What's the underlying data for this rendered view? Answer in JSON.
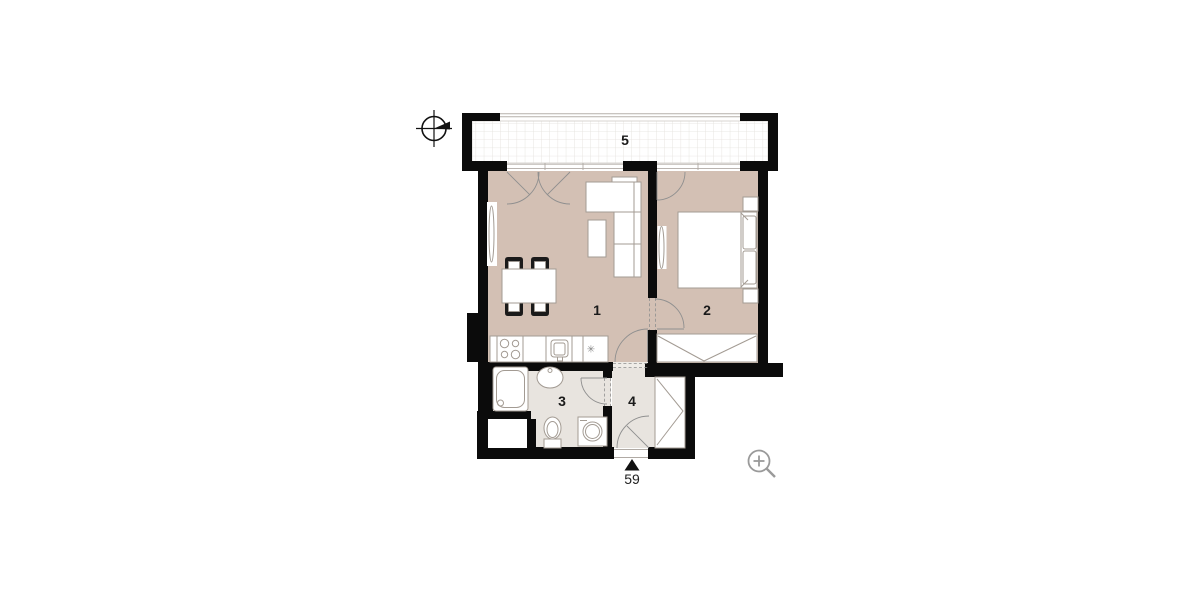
{
  "floor_plan": {
    "room_labels": {
      "living_room": "1",
      "bedroom": "2",
      "bathroom": "3",
      "hallway": "4",
      "balcony": "5"
    },
    "entrance": {
      "unit_number": "59"
    },
    "kitchen_symbol": "✳"
  },
  "icons": {
    "compass": "compass-north-icon",
    "zoom": "zoom-in-icon"
  },
  "colors": {
    "wall": "#0b0b0b",
    "room_fill": "#d3c0b4",
    "wet_room_fill": "#e8e4df",
    "threshold_fill": "#efece7",
    "furniture_fill": "#ffffff",
    "furniture_outline": "#a39b93",
    "door_arc": "#8f8f8f",
    "balcony_grid": "#e3e0db",
    "railing": "#b5b1ac",
    "icon_gray": "#9a9a9a",
    "label_color": "#1a1a1a"
  }
}
